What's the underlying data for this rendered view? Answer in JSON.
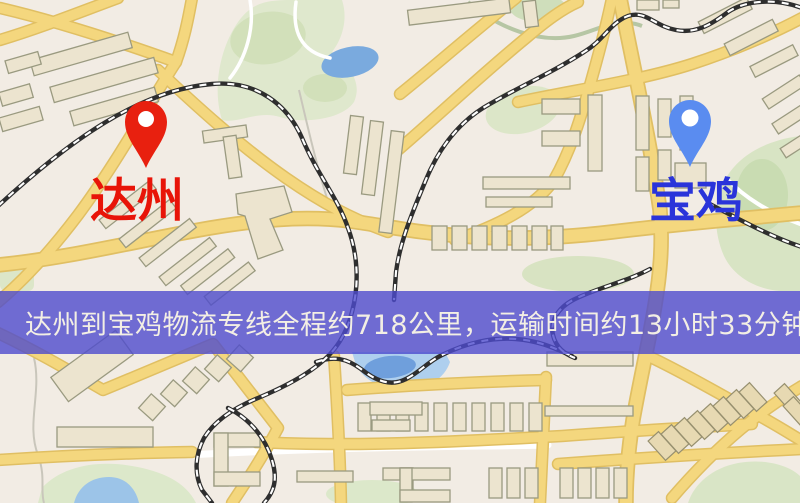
{
  "map": {
    "banner": {
      "text": "达州到宝鸡物流专线全程约718公里，运输时间约13小时33分钟.",
      "background": "#4d4bcd",
      "text_color": "#f3efe4"
    },
    "origin": {
      "name": "达州",
      "pin_color": "#e8200f",
      "label_color": "#e81408"
    },
    "destination": {
      "name": "宝鸡",
      "pin_color": "#5a8cf0",
      "label_color": "#2a34da"
    },
    "route_info": {
      "distance_text": "约718公里",
      "duration_text": "约13小时33分钟"
    },
    "palette": {
      "base": "#f2ece4",
      "road": "#f4d77e",
      "road_casing": "#e0bf63",
      "building": "#ece4cf",
      "green": "#dfe8cd",
      "water": "#7aaade",
      "railway": "#2e2e2e"
    }
  }
}
